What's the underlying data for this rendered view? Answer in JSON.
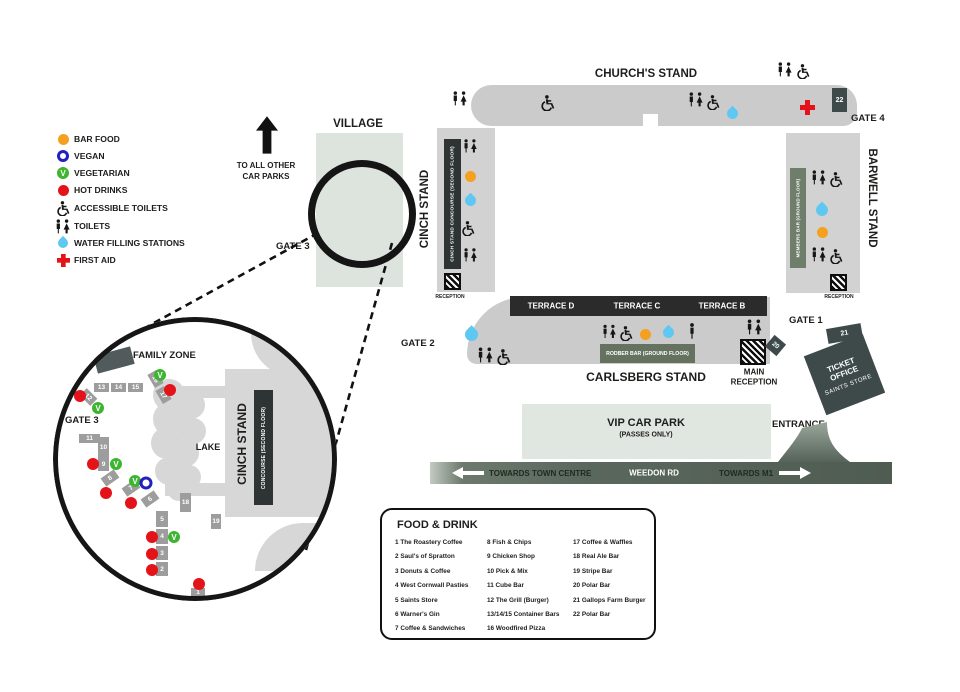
{
  "colors": {
    "orange": "#f5a01f",
    "red": "#e41319",
    "green": "#3eb531",
    "blue": "#2220c1",
    "water": "#5fc8f2",
    "stand_gray": "#cbcbcb",
    "strip_gray": "#d2d2d2",
    "dark": "#2e3434",
    "bar_green": "#657260",
    "members_green": "#6f7d6b",
    "slate": "#3e4a4a",
    "village": "#dde4de",
    "vip": "#e0e6e0",
    "box_gray": "#9d9d9d",
    "road_dark": "#4f5c52",
    "lake_gray": "#d7d7d7"
  },
  "legend": {
    "items": [
      {
        "label": "BAR FOOD",
        "type": "bar-food"
      },
      {
        "label": "VEGAN",
        "type": "vegan"
      },
      {
        "label": "VEGETARIAN",
        "type": "vegetarian"
      },
      {
        "label": "HOT DRINKS",
        "type": "hot-drinks"
      },
      {
        "label": "ACCESSIBLE TOILETS",
        "type": "accessible-toilets"
      },
      {
        "label": "TOILETS",
        "type": "toilets"
      },
      {
        "label": "WATER FILLING STATIONS",
        "type": "water"
      },
      {
        "label": "FIRST AID",
        "type": "first-aid"
      }
    ]
  },
  "village": {
    "title": "VILLAGE",
    "gate_label": "GATE 3",
    "car_parks_line1": "TO ALL OTHER",
    "car_parks_line2": "CAR PARKS"
  },
  "stadium": {
    "stands": {
      "churchs": "CHURCH'S STAND",
      "cinch": "CINCH STAND",
      "barwell": "BARWELL STAND",
      "carlsberg": "CARLSBERG STAND"
    },
    "terraces": [
      "TERRACE D",
      "TERRACE C",
      "TERRACE B"
    ],
    "bars": {
      "cinch_concourse": "CINCH STAND CONCOURSE (SECOND FLOOR)",
      "members": "MEMBERS BAR (GROUND FLOOR)",
      "rodber": "RODBER BAR (GROUND FLOOR)"
    },
    "gates": {
      "gate1": "GATE 1",
      "gate2": "GATE 2",
      "gate3": "GATE 3",
      "gate4": "GATE 4"
    },
    "badges": {
      "b20": "20",
      "b21": "21",
      "b22": "22"
    },
    "reception_label": "RECEPTION",
    "main_reception_line1": "MAIN",
    "main_reception_line2": "RECEPTION",
    "ticket_office_line1": "TICKET OFFICE",
    "ticket_office_line2": "SAINTS STORE",
    "entrance": "ENTRANCE",
    "vip_line1": "VIP CAR PARK",
    "vip_line2": "(PASSES ONLY)"
  },
  "road": {
    "left": "TOWARDS TOWN CENTRE",
    "center": "WEEDON RD",
    "right": "TOWARDS M1"
  },
  "zoom_circle": {
    "family_zone": "FAMILY ZONE",
    "gate_label": "GATE 3",
    "lake": "LAKE",
    "stand_title": "CINCH STAND",
    "stand_sub": "CONCOURSE (SECOND FLOOR)",
    "stalls": [
      {
        "n": "13",
        "x": 41,
        "y": 66,
        "w": 15,
        "h": 9
      },
      {
        "n": "14",
        "x": 58,
        "y": 66,
        "w": 15,
        "h": 9
      },
      {
        "n": "15",
        "x": 75,
        "y": 66,
        "w": 15,
        "h": 9
      },
      {
        "n": "16",
        "x": 95,
        "y": 57,
        "w": 15,
        "h": 10,
        "rot": 60
      },
      {
        "n": "17",
        "x": 103,
        "y": 73,
        "w": 15,
        "h": 10,
        "rot": 60
      },
      {
        "n": "12",
        "x": 28,
        "y": 75,
        "w": 15,
        "h": 10,
        "rot": 45
      },
      {
        "n": "11",
        "x": 26,
        "y": 117,
        "w": 21,
        "h": 9
      },
      {
        "n": "10",
        "x": 45,
        "y": 120,
        "w": 11,
        "h": 21
      },
      {
        "n": "9",
        "x": 45,
        "y": 140,
        "w": 11,
        "h": 14
      },
      {
        "n": "8",
        "x": 49,
        "y": 156,
        "w": 16,
        "h": 10,
        "rot": -35
      },
      {
        "n": "7",
        "x": 70,
        "y": 166,
        "w": 16,
        "h": 10,
        "rot": -35
      },
      {
        "n": "6",
        "x": 89,
        "y": 177,
        "w": 16,
        "h": 10,
        "rot": -35
      },
      {
        "n": "5",
        "x": 103,
        "y": 194,
        "w": 12,
        "h": 16
      },
      {
        "n": "4",
        "x": 103,
        "y": 212,
        "w": 12,
        "h": 15
      },
      {
        "n": "3",
        "x": 103,
        "y": 229,
        "w": 12,
        "h": 14
      },
      {
        "n": "2",
        "x": 103,
        "y": 245,
        "w": 12,
        "h": 14
      },
      {
        "n": "18",
        "x": 127,
        "y": 176,
        "w": 11,
        "h": 19
      },
      {
        "n": "19",
        "x": 158,
        "y": 197,
        "w": 10,
        "h": 15
      },
      {
        "n": "1",
        "x": 138,
        "y": 271,
        "w": 14,
        "h": 9
      }
    ],
    "markers": [
      {
        "type": "hot",
        "x": 27,
        "y": 79
      },
      {
        "type": "hot",
        "x": 117,
        "y": 73
      },
      {
        "type": "hot",
        "x": 40,
        "y": 147
      },
      {
        "type": "hot",
        "x": 53,
        "y": 176
      },
      {
        "type": "hot",
        "x": 78,
        "y": 186
      },
      {
        "type": "hot",
        "x": 99,
        "y": 220
      },
      {
        "type": "hot",
        "x": 99,
        "y": 237
      },
      {
        "type": "hot",
        "x": 99,
        "y": 253
      },
      {
        "type": "hot",
        "x": 146,
        "y": 267
      },
      {
        "type": "veg",
        "x": 107,
        "y": 58
      },
      {
        "type": "veg",
        "x": 45,
        "y": 91
      },
      {
        "type": "veg",
        "x": 63,
        "y": 147
      },
      {
        "type": "veg",
        "x": 82,
        "y": 164
      },
      {
        "type": "veg",
        "x": 121,
        "y": 220
      },
      {
        "type": "vegan",
        "x": 93,
        "y": 166
      }
    ]
  },
  "food_drink": {
    "title": "FOOD & DRINK",
    "columns": [
      [
        "1 The Roastery Coffee",
        "2 Saul's of Spratton",
        "3 Donuts & Coffee",
        "4 West Cornwall Pasties",
        "5 Saints Store",
        "6 Warner's Gin",
        "7 Coffee & Sandwiches"
      ],
      [
        "8 Fish & Chips",
        "9 Chicken Shop",
        "10 Pick & Mix",
        "11 Cube Bar",
        "12 The Grill (Burger)",
        "13/14/15 Container Bars",
        "16 Woodfired Pizza"
      ],
      [
        "17 Coffee & Waffles",
        "18 Real Ale Bar",
        "19 Stripe Bar",
        "20 Polar Bar",
        "21 Gallops Farm Burger",
        "22 Polar Bar"
      ]
    ]
  }
}
